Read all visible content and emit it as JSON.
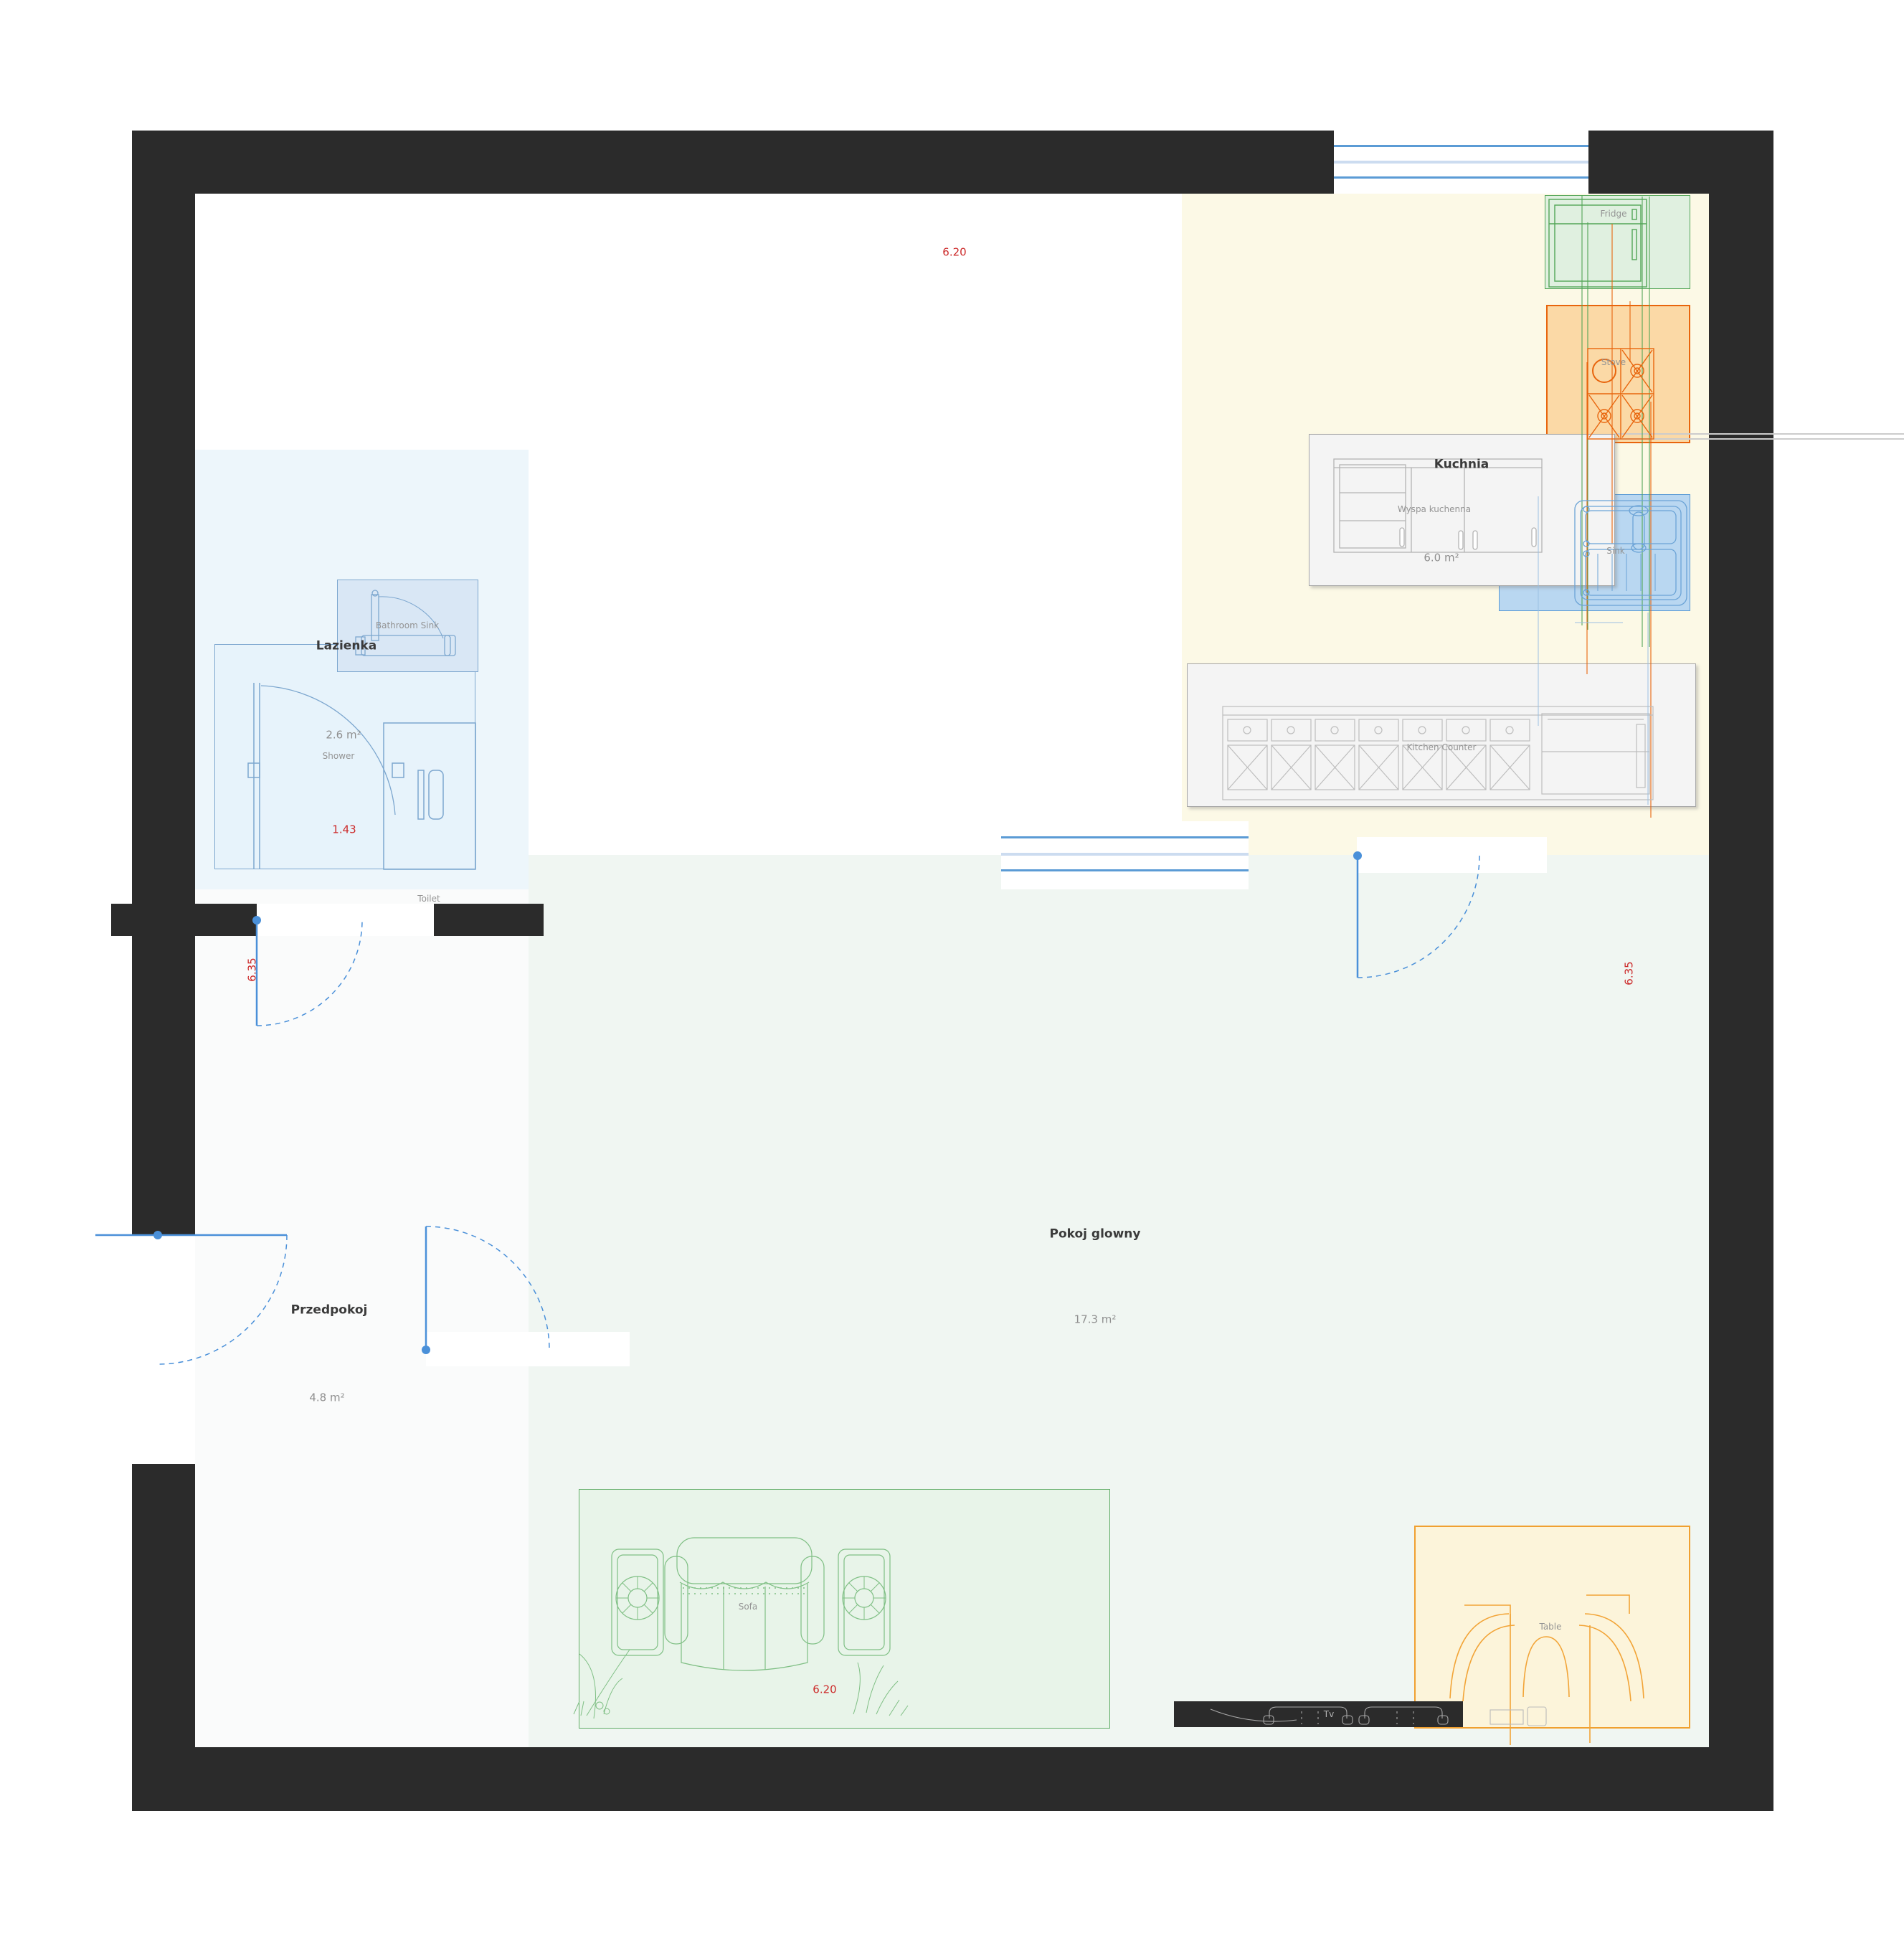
{
  "plan": {
    "title": "Apartment floor plan",
    "rooms": {
      "lazienka": {
        "label": "Lazienka",
        "area": "2.6 m²"
      },
      "przedpokoj": {
        "label": "Przedpokoj",
        "area": "4.8 m²"
      },
      "pokoj_glowny": {
        "label": "Pokoj glowny",
        "area": "17.3 m²"
      },
      "kuchnia": {
        "label": "Kuchnia",
        "area": "6.0 m²",
        "island_label": "Wyspa kuchenna"
      }
    },
    "furniture": {
      "shower": "Shower",
      "toilet": "Toilet",
      "bathroom_sink": "Bathroom Sink",
      "fridge": "Fridge",
      "stove": "Stove",
      "sink": "Sink",
      "kitchen_counter": "Kitchen Counter",
      "sofa": "Sofa",
      "table": "Table",
      "tv": "Tv"
    },
    "dimensions": {
      "top_width": "6.20",
      "sofa_width": "6.20",
      "shower_width": "1.43",
      "left_height": "6.35",
      "right_height": "6.35"
    },
    "colors": {
      "wall": "#2b2b2b",
      "door": "#4a90d9",
      "window": "#5b9bd5",
      "dimension_text": "#cc2a2a",
      "kitchen_floor": "#fcf9e6",
      "main_room_floor": "#f0f6f2",
      "hall_floor": "#fafbfb",
      "bathroom_floor": "#edf6fb",
      "fridge_accent": "#53a557",
      "stove_accent": "#e8650d",
      "sink_accent": "#5b9bd5",
      "sofa_accent": "#62ad68",
      "table_accent": "#f0a030"
    }
  }
}
